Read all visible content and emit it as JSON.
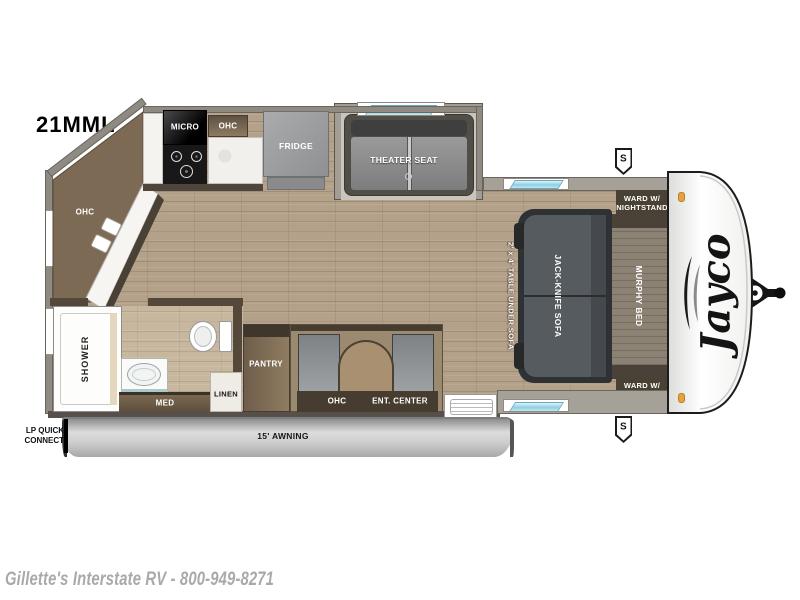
{
  "title": "21MML",
  "brand": "Jayco",
  "footer": {
    "dealer_line": "Gillette's Interstate RV - 800-949-8271"
  },
  "labels": {
    "micro": "MICRO",
    "ohc": "OHC",
    "fridge": "FRIDGE",
    "theater_seat": "THEATER SEAT",
    "shower": "SHOWER",
    "med": "MED",
    "linen": "LINEN",
    "pantry": "PANTRY",
    "ent_center": "ENT. CENTER",
    "table": "2' x 4' TABLE UNDER SOFA",
    "sofa": "JACK-KNIFE SOFA",
    "murphy_bed": "MURPHY BED",
    "ward": "WARD W/ NIGHTSTAND",
    "awning": "15' AWNING",
    "lp": "LP QUICK CONNECT",
    "speaker": "S"
  },
  "colors": {
    "wood": "#b4a18a",
    "wall": "#8f8b83",
    "glass": "#8ecfe4",
    "cabinet": "#7a6853",
    "label_dark": "#463d30",
    "marker_light": "#e6a23c"
  }
}
